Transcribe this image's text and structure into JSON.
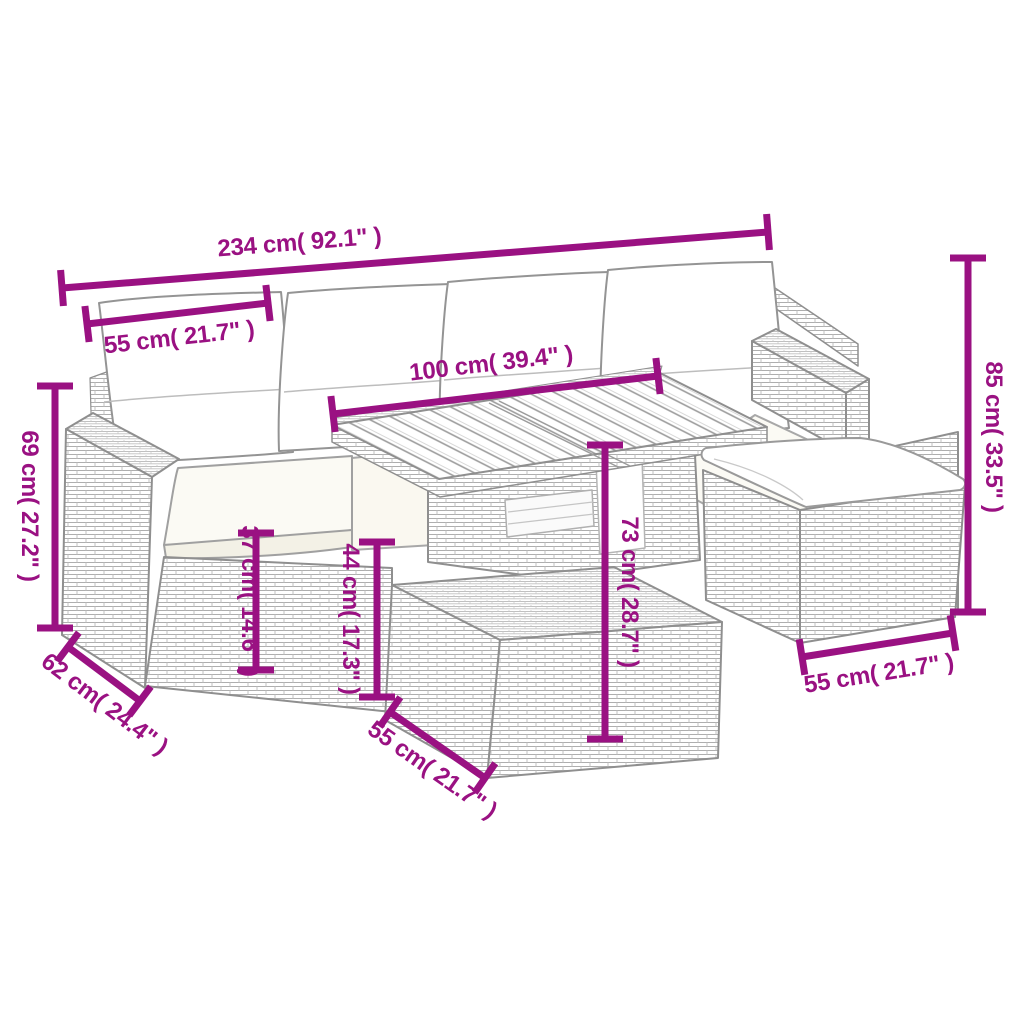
{
  "diagram": {
    "type": "product dimension drawing",
    "subject": "rattan garden lounge set with table and ottomans",
    "background": "#ffffff",
    "accent_color": "#9A1182",
    "line_art_color": "#8f8f8f"
  },
  "measurements": {
    "overall_width": "234 cm( 92.1\" )",
    "seat_width": "55 cm( 21.7\" )",
    "table_length": "100 cm( 39.4\" )",
    "total_height": "85 cm( 33.5\" )",
    "arm_height": "69 cm( 27.2\" )",
    "seat_height": "37 cm( 14.6\" )",
    "ottoman_height": "44 cm( 17.3\" )",
    "table_height": "73 cm( 28.7\" )",
    "seat_depth": "62 cm( 24.4\" )",
    "ottoman_width": "55 cm( 21.7\" )",
    "ottoman_depth": "55 cm( 21.7\" )"
  }
}
